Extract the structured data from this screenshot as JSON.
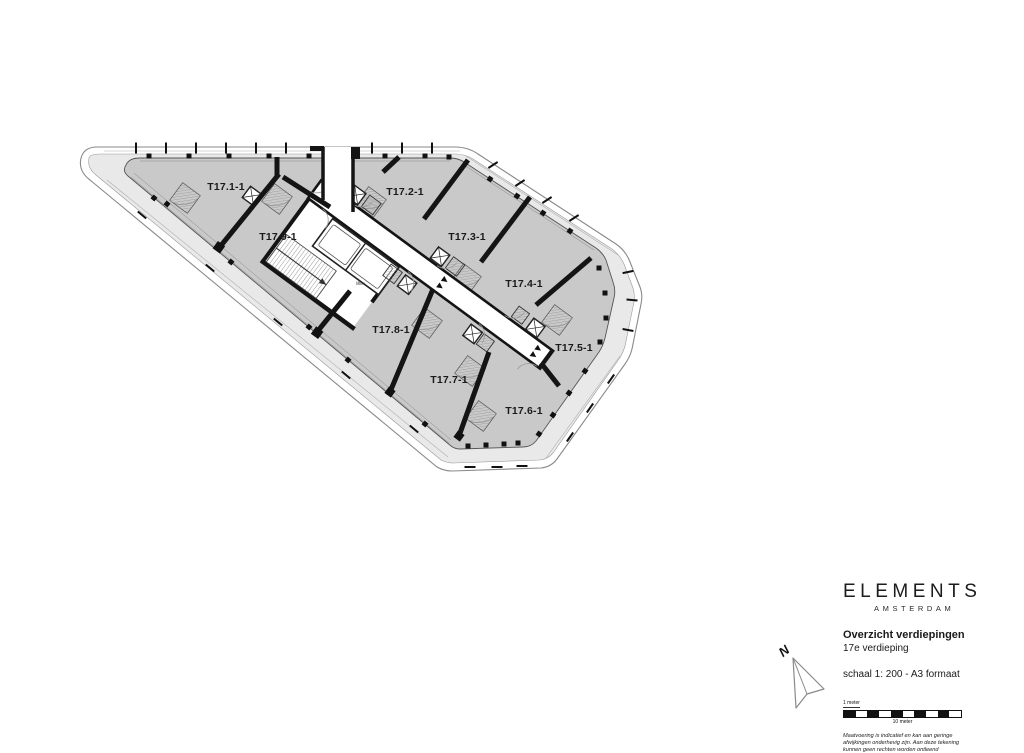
{
  "plan": {
    "units": [
      {
        "label": "T17.1-1"
      },
      {
        "label": "T17.2-1"
      },
      {
        "label": "T17.3-1"
      },
      {
        "label": "T17.4-1"
      },
      {
        "label": "T17.5-1"
      },
      {
        "label": "T17.6-1"
      },
      {
        "label": "T17.7-1"
      },
      {
        "label": "T17.8-1"
      },
      {
        "label": "T17.9-1"
      }
    ],
    "core_label": "liften"
  },
  "titleblock": {
    "brand": "ELEMENTS",
    "brand_subtitle": "AMSTERDAM",
    "drawing_title": "Overzicht verdiepingen",
    "floor_label": "17e verdieping",
    "scale_label": "schaal 1: 200 - A3 formaat",
    "scalebar": {
      "start_label": "1 meter",
      "end_label": "10 meter",
      "segment_count": 10
    },
    "north_label": "N",
    "disclaimer_lines": [
      "Maatvoering is indicatief en kan aan geringe",
      "afwijkingen onderhevig zijn. Aan deze tekening",
      "kunnen geen rechten worden ontleend"
    ]
  },
  "colors": {
    "floor_fill": "#c9c9c9",
    "terrace_fill": "#e9e9e9",
    "corridor_fill": "#ffffff",
    "wall": "#141414",
    "outline": "#8a8a8a"
  }
}
